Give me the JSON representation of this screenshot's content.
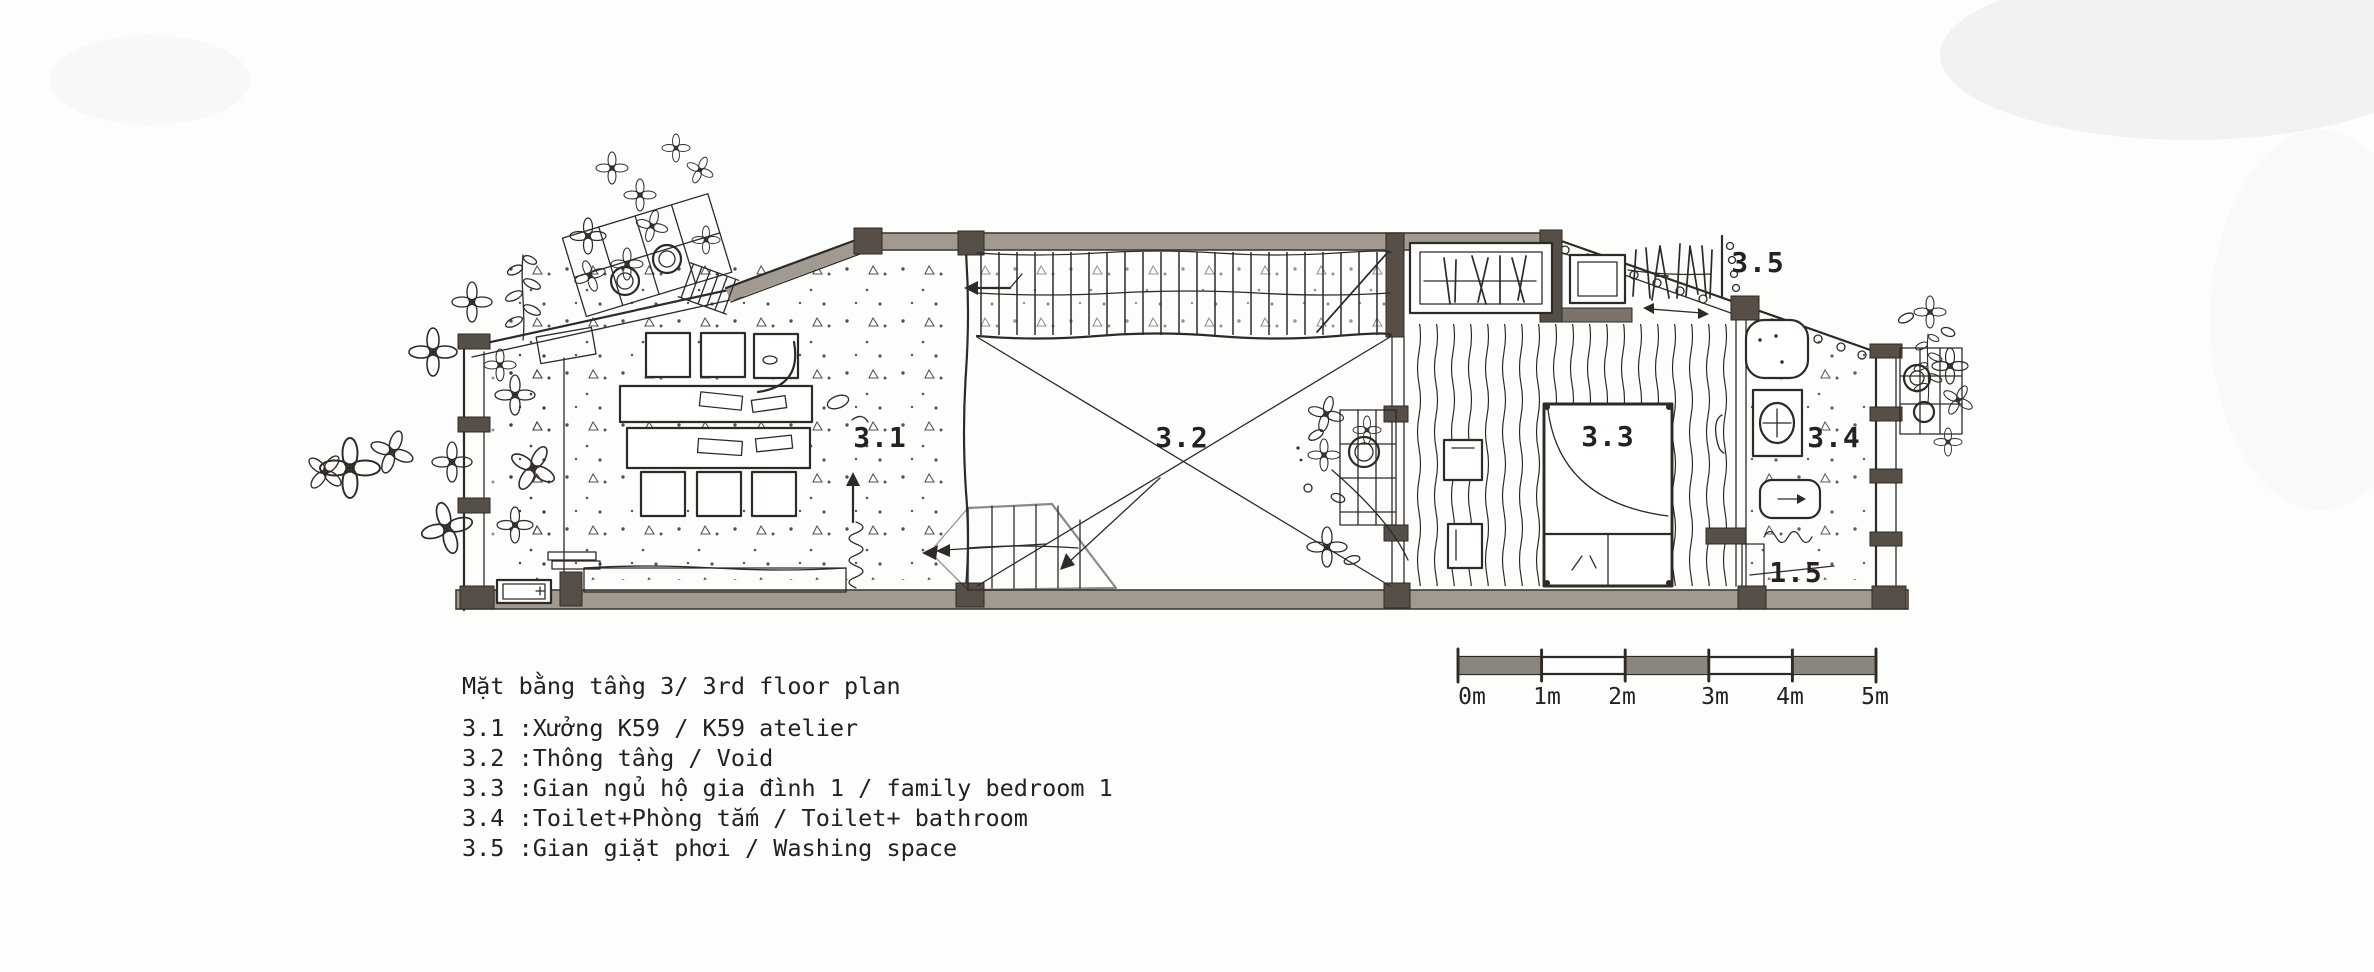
{
  "title": "Mặt bằng tầng 3/ 3rd floor plan",
  "rooms": [
    {
      "code": "3.1",
      "legend": "3.1 :Xưởng K59 / K59 atelier"
    },
    {
      "code": "3.2",
      "legend": "3.2 :Thông tầng / Void"
    },
    {
      "code": "3.3",
      "legend": "3.3 :Gian ngủ hộ gia đình 1 / family bedroom 1"
    },
    {
      "code": "3.4",
      "legend": "3.4 :Toilet+Phòng tắm / Toilet+ bathroom"
    },
    {
      "code": "3.5",
      "legend": "3.5 :Gian giặt phơi / Washing space"
    }
  ],
  "plan_annotations": {
    "stair_well_label": "1.5"
  },
  "scale_bar": {
    "labels": [
      "0m",
      "1m",
      "2m",
      "3m",
      "4m",
      "5m"
    ]
  },
  "palette": {
    "ink": "#2e2a26",
    "wall_gray": "#a19a90",
    "wall_dark": "#554f48",
    "paper": "#fdfdfc"
  }
}
